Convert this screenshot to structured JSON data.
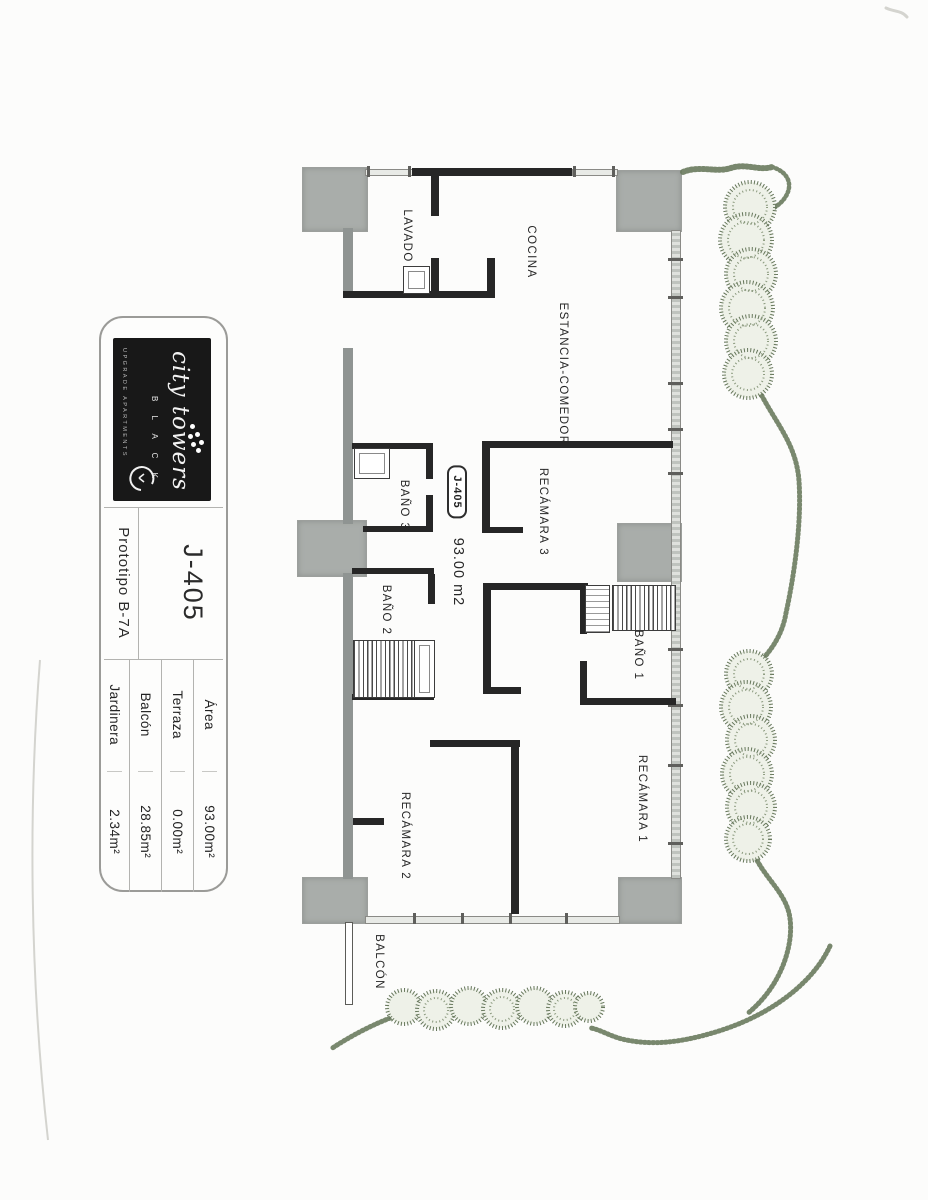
{
  "title_block": {
    "logo": {
      "brand": "city towers",
      "black": "B L A C K",
      "tagline": "UPGRADE APARTMENTS"
    },
    "unit_number": "J-405",
    "prototype": "Prototipo  B-7A",
    "specs": [
      {
        "label": "Área",
        "value": "93.00m²"
      },
      {
        "label": "Terraza",
        "value": "0.00m²"
      },
      {
        "label": "Balcón",
        "value": "28.85m²"
      },
      {
        "label": "Jardinera",
        "value": "2.34m²"
      }
    ]
  },
  "floorplan": {
    "unit_tag": "J-405",
    "area_text": "93.00 m2",
    "rooms": [
      {
        "label": "LAVADO"
      },
      {
        "label": "COCINA"
      },
      {
        "label": "ESTANCIA-COMEDOR"
      },
      {
        "label": "RECÁMARA 3"
      },
      {
        "label": "BAÑO 3"
      },
      {
        "label": "BAÑO 2"
      },
      {
        "label": "BAÑO 1"
      },
      {
        "label": "RECÁMARA 1"
      },
      {
        "label": "RECÁMARA 2"
      },
      {
        "label": "BALCÓN"
      }
    ]
  },
  "colors": {
    "wall": "#262626",
    "column_gray": "#a9adaa",
    "vegetation_green": "#6a7b5e",
    "logo_background": "#181818"
  }
}
